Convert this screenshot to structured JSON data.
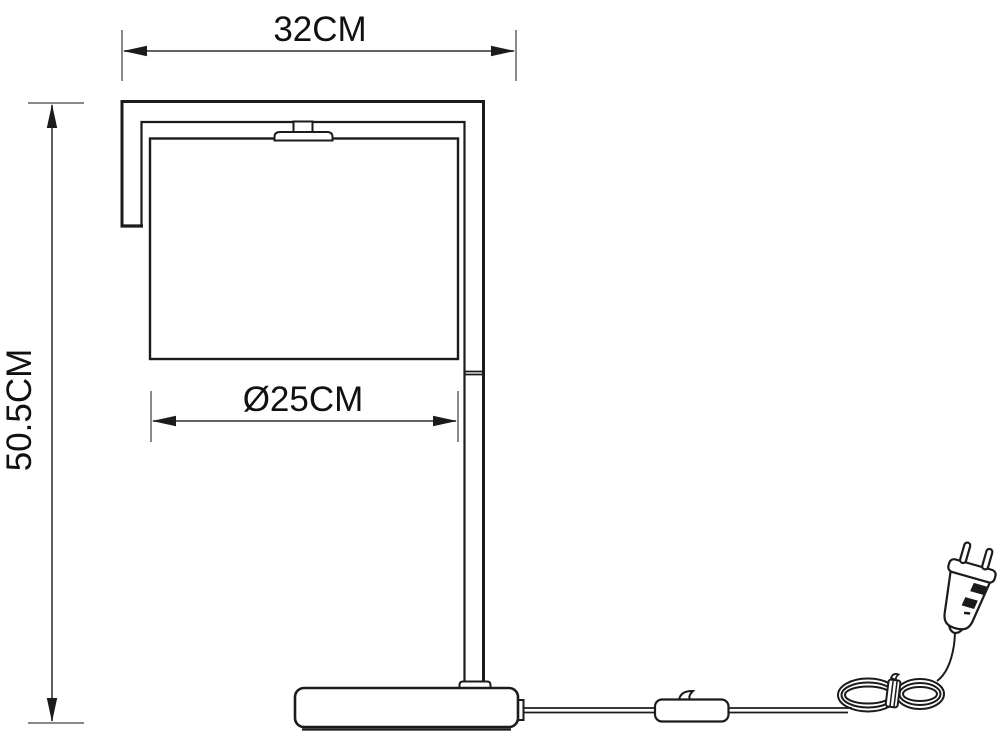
{
  "figure": {
    "subject": "table-lamp-technical-drawing",
    "background_color": "#ffffff",
    "line_color": "#1b1b1b",
    "dimension_line_color": "#4d4d4d",
    "extension_tick_color": "#8a8a8a",
    "label_color": "#111111"
  },
  "labels": {
    "overall_width": "32CM",
    "overall_height": "50.5CM",
    "shade_diameter": "Ø25CM"
  },
  "parts": [
    "frame-arm",
    "lampshade",
    "bulb-holder",
    "support-post",
    "post-joint",
    "base",
    "cord-outlet",
    "power-cord",
    "inline-switch",
    "coiled-cord",
    "euro-plug"
  ]
}
